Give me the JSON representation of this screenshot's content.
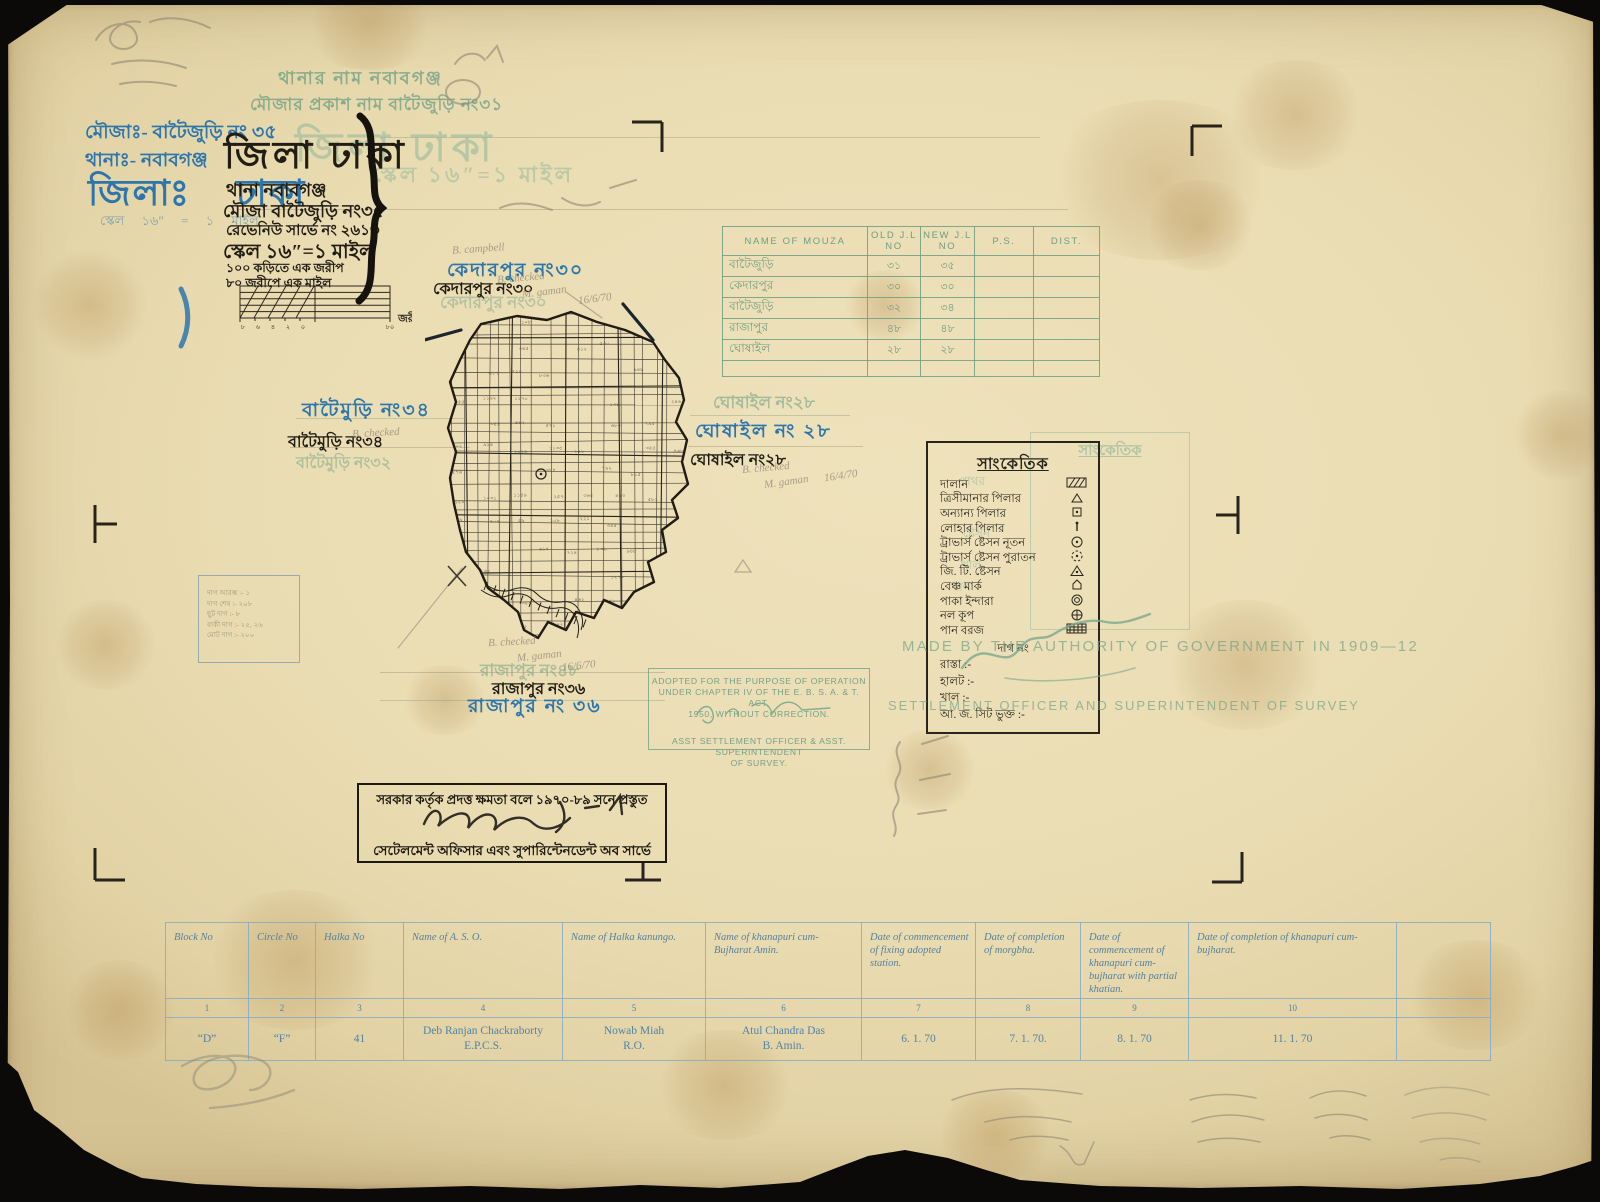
{
  "header": {
    "green_line1": "থানার নাম   নবাবগঞ্জ",
    "green_line2": "মৌজার প্রকাশ নাম বাটৈজুড়ি নং৩১",
    "blue_mouza": "মৌজাঃ- বাটৈজুড়ি নং ৩৫",
    "blue_thana": "থানাঃ- নবাবগঞ্জ",
    "blue_district": "জিলাঃ  ঢাকা",
    "blue_scale_faint": "স্কেল  ১৬″ = ১ মাইল",
    "green_district_ghost": "জিলা ঢাকা",
    "green_scale_ghost": "স্কেল ১৬″=১ মাইল",
    "black_district": "জিলা ঢাকা",
    "black_thana": "থানা নবাবগঞ্জ",
    "black_mouza": "মৌজা বাটৈজুড়ি নং৩৫",
    "black_survey": "রেভেনিউ সার্ভে নং ২৬১৩",
    "black_scale": "স্কেল ১৬″=১ মাইল",
    "black_sub1": "১০০ কড়িতে এক জরীপ",
    "black_sub2": "৮০ জরীপে এক মাইল",
    "scalebar_label": "জরীপ",
    "scalebar_ticks": [
      "৮",
      "৬",
      "৪",
      "২",
      "০",
      "৮০"
    ]
  },
  "neighbors": {
    "north_blue": "কেদারপুর নং৩০",
    "north_black": "কেদারপুর নং৩০",
    "north_green": "কেদারপুর নং৩০",
    "west_blue": "বাটৈমুড়ি নং৩৪",
    "west_black": "বাটৈমুড়ি নং৩৪",
    "west_green": "বাটৈমুড়ি নং৩২",
    "east_green": "ঘোষাইল নং২৮",
    "east_blue": "ঘোষাইল নং ২৮",
    "east_black": "ঘোষাইল নং২৮",
    "south_green": "রাজাপুর নং৪৮",
    "south_black": "রাজাপুর নং৩৬",
    "south_blue": "রাজাপুর নং ৩৬"
  },
  "mouza_table": {
    "headers": [
      "NAME OF MOUZA",
      "OLD J.L NO",
      "NEW J.L NO",
      "P.S.",
      "DIST."
    ],
    "rows": [
      [
        "বাটৈজুড়ি",
        "৩১",
        "৩৫",
        "",
        ""
      ],
      [
        "কেদারপুর",
        "৩০",
        "৩০",
        "",
        ""
      ],
      [
        "বাটৈজুড়ি",
        "৩২",
        "৩৪",
        "",
        ""
      ],
      [
        "রাজাপুর",
        "৪৮",
        "৪৮",
        "",
        ""
      ],
      [
        "ঘোষাইল",
        "২৮",
        "২৮",
        "",
        ""
      ],
      [
        "",
        "",
        "",
        "",
        ""
      ]
    ]
  },
  "legend": {
    "title": "সাংকেতিক",
    "items": [
      {
        "label": "দালান",
        "symbol": "hatch-rect"
      },
      {
        "label": "ত্রিসীমানার পিলার",
        "symbol": "triangle"
      },
      {
        "label": "অন্যান্য পিলার",
        "symbol": "square-dot"
      },
      {
        "label": "লোহার পিলার",
        "symbol": "iron-pillar"
      },
      {
        "label": "ট্রাভার্স ষ্টেসন নূতন",
        "symbol": "circle-dot"
      },
      {
        "label": "ট্রাভার্স ষ্টেসন পুরাতন",
        "symbol": "dashed-circle-dot"
      },
      {
        "label": "জি. টি. ষ্টেসন",
        "symbol": "triangle-dot"
      },
      {
        "label": "বেঞ্চ মার্ক",
        "symbol": "benchmark"
      },
      {
        "label": "পাকা ইন্দারা",
        "symbol": "double-circle"
      },
      {
        "label": "নল কূপ",
        "symbol": "circle-cross"
      },
      {
        "label": "পান বরজ",
        "symbol": "dense-hatch"
      }
    ],
    "footer": [
      "দাগ নং",
      "রাস্তা :-",
      "হালট :-",
      "খাল :-",
      "আ. জ. সিট ভুক্ত :-"
    ],
    "ghost_title": "সাংকেতিক",
    "ghost_words": [
      "পাথর",
      "ষ্টেসন",
      "দাগ",
      "খাল"
    ]
  },
  "stamps": {
    "adopted": [
      "ADOPTED FOR THE PURPOSE OF OPERATION",
      "UNDER CHAPTER IV OF THE E. B. S. A. & T. ACT,",
      "1950, WITHOUT CORRECTION.",
      "ASST SETTLEMENT OFFICER & ASST. SUPERINTENDENT",
      "OF SURVEY."
    ],
    "authority_line1": "MADE BY THE AUTHORITY OF GOVERNMENT IN 1909—12",
    "authority_line2": "SETTLEMENT OFFICER AND SUPERINTENDENT OF SURVEY",
    "blackbox_line1": "সরকার কর্তৃক প্রদত্ত ক্ষমতা বলে ১৯৭০-৮৯ সনে প্রস্তুত",
    "blackbox_line2": "সেটেলমেন্ট অফিসার এবং সুপারিন্টেনডেন্ট অব সার্ভে"
  },
  "bottom_table": {
    "headers": [
      "Block No",
      "Circle No",
      "Halka No",
      "Name of   A. S. O.",
      "Name of Halka kanungo.",
      "Name of khanapuri cum-Bujharat Amin.",
      "Date of commencement of fixing adopted station.",
      "Date of completion of morgbha.",
      "Date of commencement of khanapuri cum-bujharat with partial khatian.",
      "Date of completion of khanapuri cum-bujharat.",
      ""
    ],
    "numbers": [
      "1",
      "2",
      "3",
      "4",
      "5",
      "6",
      "7",
      "8",
      "9",
      "10",
      ""
    ],
    "values": [
      "“D”",
      "“F”",
      "41",
      "Deb Ranjan Chackraborty\nE.P.C.S.",
      "Nowab   Miah\nR.O.",
      "Atul   Chandra   Das\nB. Amin.",
      "6. 1. 70",
      "7. 1. 70.",
      "8. 1. 70",
      "11. 1. 70",
      ""
    ],
    "col_widths": [
      83,
      67,
      88,
      159,
      143,
      156,
      114,
      105,
      108,
      208,
      94
    ]
  },
  "faint_box_lines": [
    "দাগ আরম্ভ :-  ১",
    "দাগ শেষ :-  ২০৮",
    "ছুট দাগ :-  ৮",
    "বাকী দাগ :-  ২৫, ২৬",
    "মোট দাগ :-  ২০০"
  ],
  "annotations": [
    {
      "text": "B. campbell",
      "x": 452,
      "y": 243,
      "rot": -4
    },
    {
      "text": "B. checked",
      "x": 497,
      "y": 272,
      "rot": -5
    },
    {
      "text": "M. gaman",
      "x": 522,
      "y": 286,
      "rot": -7
    },
    {
      "text": "16/6/70",
      "x": 578,
      "y": 293,
      "rot": -7
    },
    {
      "text": "B. checked",
      "x": 352,
      "y": 427,
      "rot": -3
    },
    {
      "text": "B. checked",
      "x": 742,
      "y": 462,
      "rot": -5
    },
    {
      "text": "M. gaman",
      "x": 764,
      "y": 476,
      "rot": -8
    },
    {
      "text": "16/4/70",
      "x": 824,
      "y": 470,
      "rot": -8
    },
    {
      "text": "B. checked",
      "x": 488,
      "y": 636,
      "rot": -3
    },
    {
      "text": "M. gaman",
      "x": 517,
      "y": 650,
      "rot": -6
    },
    {
      "text": "16/6/70",
      "x": 562,
      "y": 660,
      "rot": -6
    }
  ],
  "map": {
    "boundary": "56,26 92,18 122,22 146,14 172,24 200,32 228,44 240,62 254,80 259,102 251,124 262,142 257,164 263,186 247,202 253,220 237,232 241,254 223,264 229,284 209,294 197,310 179,302 169,320 151,314 141,332 123,324 113,340 99,332 93,314 79,302 63,290 55,272 41,254 35,232 29,206 25,180 31,154 23,130 31,104 25,84 35,62 45,42",
    "plot_numbers": [
      "৫৯",
      "১০৮",
      "২২১",
      "৩৪৫",
      "৪১২",
      "৫৩০",
      "৬১৭",
      "৭২৪",
      "৮৩৬",
      "৯৪৮",
      "১০৫৫",
      "১১৬২",
      "১২৭০",
      "১৩৮",
      "২৪৬",
      "৩৫৪",
      "৪৬২",
      "৫৭১",
      "৬৮৩",
      "৭৯৫",
      "৮০২",
      "৯১৪",
      "১০২৬",
      "১১৩৪",
      "২৪২",
      "৩৫৫",
      "৪৬৮",
      "৫৭৬",
      "৬৮৪",
      "৭৯২",
      "৮১৫",
      "৯২৩",
      "১০৩১",
      "১১৪৯",
      "২৫৭",
      "৩৬৫",
      "৪৭৩",
      "৫৮১",
      "৬৯৯",
      "৭০৭"
    ]
  }
}
